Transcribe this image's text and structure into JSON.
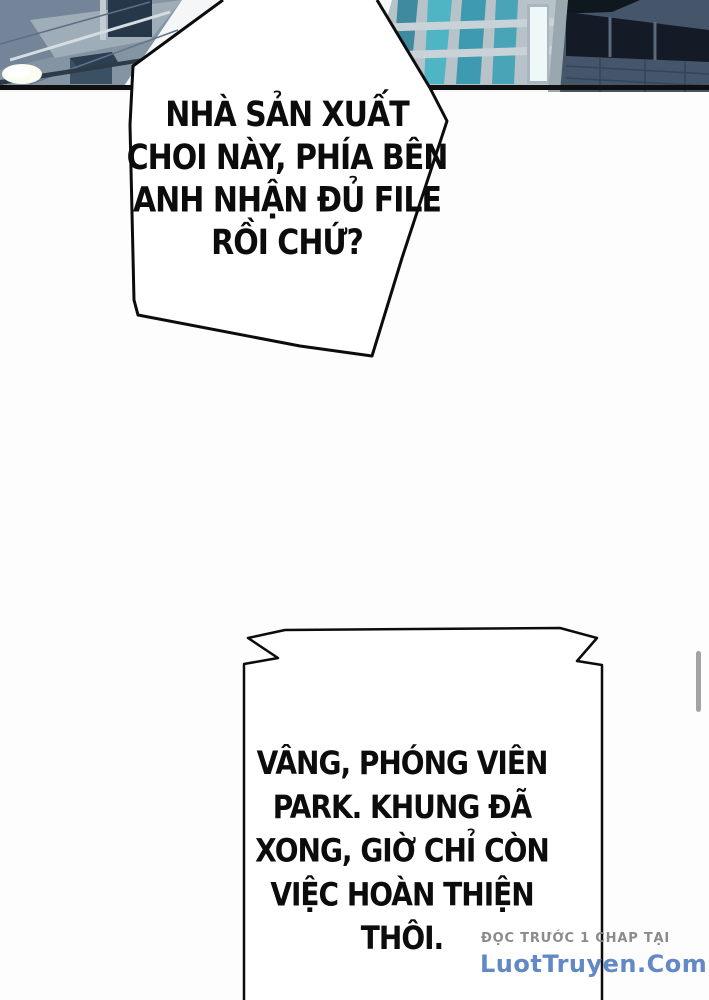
{
  "page": {
    "kind": "webtoon-comic-page",
    "background_color": "#fdfdfd"
  },
  "photo": {
    "description": "city office buildings with glass facades",
    "colors": {
      "left_building": "#8494a2",
      "middle_building": "#b7c2c9",
      "right_building": "#46566a",
      "window_teal": "#4fb4c4",
      "border_black": "#101010"
    }
  },
  "speech": {
    "bubble1": {
      "lines": [
        "NHÀ SẢN XUẤT",
        "CHOI NÀY, PHÍA BÊN",
        "ANH NHẬN ĐỦ FILE",
        "RỒI CHỨ?"
      ]
    },
    "bubble2": {
      "lines": [
        "VÂNG, PHÓNG VIÊN",
        "PARK. KHUNG ĐÃ",
        "XONG, GIỜ CHỈ CÒN",
        "VIỆC HOÀN THIỆN",
        "THÔI."
      ]
    }
  },
  "watermark": {
    "line1": "ĐỌC TRƯỚC 1 CHAP TẠI",
    "line2": "LuotTruyen.Com",
    "line1_color": "#8b8b8b",
    "line2_color": "#6288c6"
  },
  "scrollbar": {
    "present": true,
    "color": "#a3a3a3"
  }
}
